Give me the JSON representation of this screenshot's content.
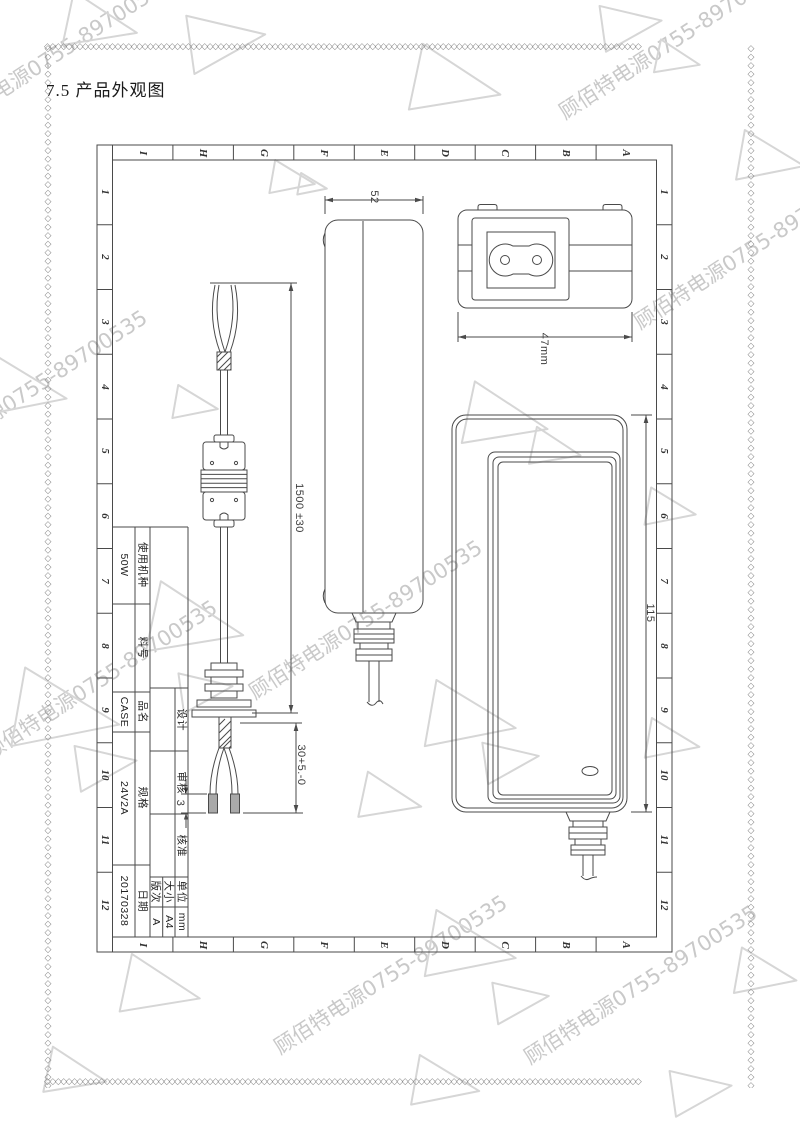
{
  "page": {
    "title": "7.5 产品外观图"
  },
  "frame": {
    "columns": [
      "I",
      "H",
      "G",
      "F",
      "E",
      "D",
      "C",
      "B",
      "A"
    ],
    "rows": [
      "1",
      "2",
      "3",
      "4",
      "5",
      "6",
      "7",
      "8",
      "9",
      "10",
      "11",
      "12"
    ]
  },
  "title_block": {
    "rows": [
      {
        "label": "使用机种",
        "value": "50W"
      },
      {
        "label": "料号",
        "value": ""
      },
      {
        "label": "品名",
        "value": "CASE"
      },
      {
        "label": "规格",
        "value": "24V2A"
      },
      {
        "label": "日期",
        "value": "20170328"
      }
    ],
    "signoff": [
      {
        "label": "设计",
        "value": ""
      },
      {
        "label": "审核",
        "value": ""
      },
      {
        "label": "核准",
        "value": ""
      }
    ],
    "meta": [
      {
        "label": "版次",
        "value": "A"
      },
      {
        "label": "大小",
        "value": "A4"
      },
      {
        "label": "单位",
        "value": "mm"
      }
    ]
  },
  "dimensions": {
    "side_width": "52",
    "inlet_width": "47mm",
    "front_height": "115",
    "cable_length": "1500 ±30",
    "output_strip": "30+5.-0",
    "tip_strip": "3"
  },
  "watermark": {
    "text": "顾佰特电源0755-89700535",
    "color": "#c9c9c9"
  },
  "decoration": {
    "border_glyph": "◇",
    "triangle_color": "#d6d6d6",
    "line_color": "#4a4a4a"
  }
}
